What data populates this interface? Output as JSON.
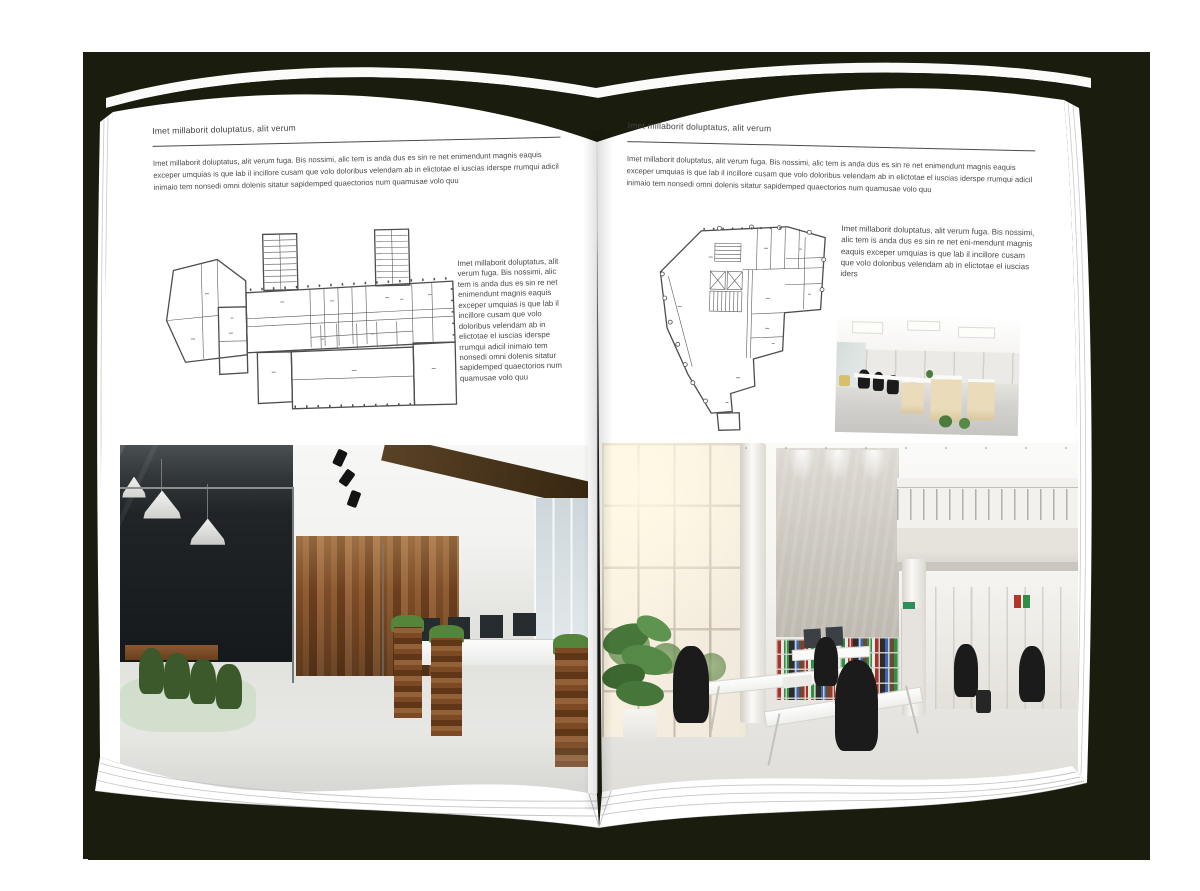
{
  "colors": {
    "backdrop": "#1a1c0d",
    "page": "#ffffff",
    "body_text": "#4a4a4a",
    "rule": "#4a4a4a"
  },
  "left_page": {
    "header": "Imet millaborit doluptatus, alit verum",
    "intro": "Imet millaborit doluptatus, alit verum fuga. Bis nossimi, alic tem is anda dus es sin re net enimendunt magnis eaquis exceper umquias is que lab il incillore cusam que volo doloribus velendam ab in elictotae el iuscias iderspe rrumqui adicil inimaio tem nonsedi omni dolenis sitatur sapidemped quaectorios num quamusae volo quu",
    "side_text": "Imet millaborit doluptatus, alit verum fuga. Bis nossimi, alic tem is anda dus es sin re net enimendunt magnis eaquis exceper umquias is que lab il incillore cusam que volo doloribus velendam ab in elictotae el iuscias iderspe rrumqui adicil inimaio tem nonsedi omni dolenis sitatur sapidemped quaectorios num quamusae volo quu"
  },
  "right_page": {
    "header": "Imet millaborit doluptatus, alit verum",
    "intro": "Imet millaborit doluptatus, alit verum fuga. Bis nossimi, alic tem is anda dus es sin re net enimendunt magnis eaquis exceper umquias is que lab il incillore cusam que volo doloribus velendam ab in elictotae el iuscias iderspe rrumqui adicil inimaio tem nonsedi omni dolenis sitatur sapidemped quaectorios num quamusae volo quu",
    "side_text": "Imet millaborit doluptatus, alit verum fuga. Bis nossimi, alic tem is anda dus es sin re net eni-mendunt magnis eaquis exceper umquias is que lab il incillore cusam que volo doloribus velendam ab in elictotae el iuscias iders"
  }
}
